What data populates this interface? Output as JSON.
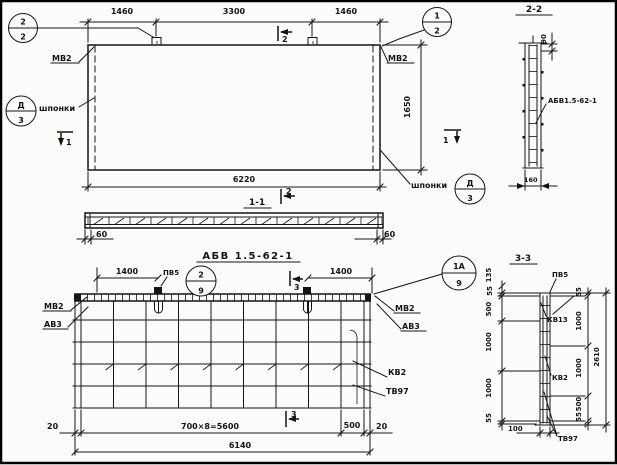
{
  "plan": {
    "dim_1460_left": "1460",
    "dim_3300": "3300",
    "dim_1460_right": "1460",
    "dim_6220": "6220",
    "dim_1650": "1650",
    "balloon_tl_top": "2",
    "balloon_tl_bot": "2",
    "balloon_tr_top": "1",
    "balloon_tr_bot": "2",
    "label_mv2": "МВ2",
    "label_shponki": "шпонки",
    "balloon_key_top": "Д",
    "balloon_key_bot": "3",
    "mark_1": "1",
    "mark_2": "2"
  },
  "sec11": {
    "title": "1-1",
    "mark_2": "2",
    "dim_60": "60",
    "caption": "АБВ 1.5-62-1"
  },
  "sec22": {
    "title": "2-2",
    "dim_90": "90",
    "dim_160": "160",
    "label": "АБВ1.5-62-1"
  },
  "mesh": {
    "dim_1400": "1400",
    "label_pv5": "ПВ5",
    "balloon_2": "2",
    "balloon_9": "9",
    "balloon_1a": "1А",
    "label_mv2": "МВ2",
    "label_av3": "АВ3",
    "label_kv2": "КВ2",
    "label_tv97": "ТВ97",
    "dim_20": "20",
    "dim_700x8": "700×8=5600",
    "dim_500": "500",
    "dim_6140": "6140",
    "mark_3": "3"
  },
  "sec33": {
    "title": "3-3",
    "label_pv5": "ПВ5",
    "label_kv13": "КВ13",
    "label_kv2": "КВ2",
    "label_tv97": "ТВ97",
    "dim_135": "135",
    "dim_55": "55",
    "dim_500": "500",
    "dim_1000": "1000",
    "dim_2610": "2610",
    "dim_100": "100"
  }
}
